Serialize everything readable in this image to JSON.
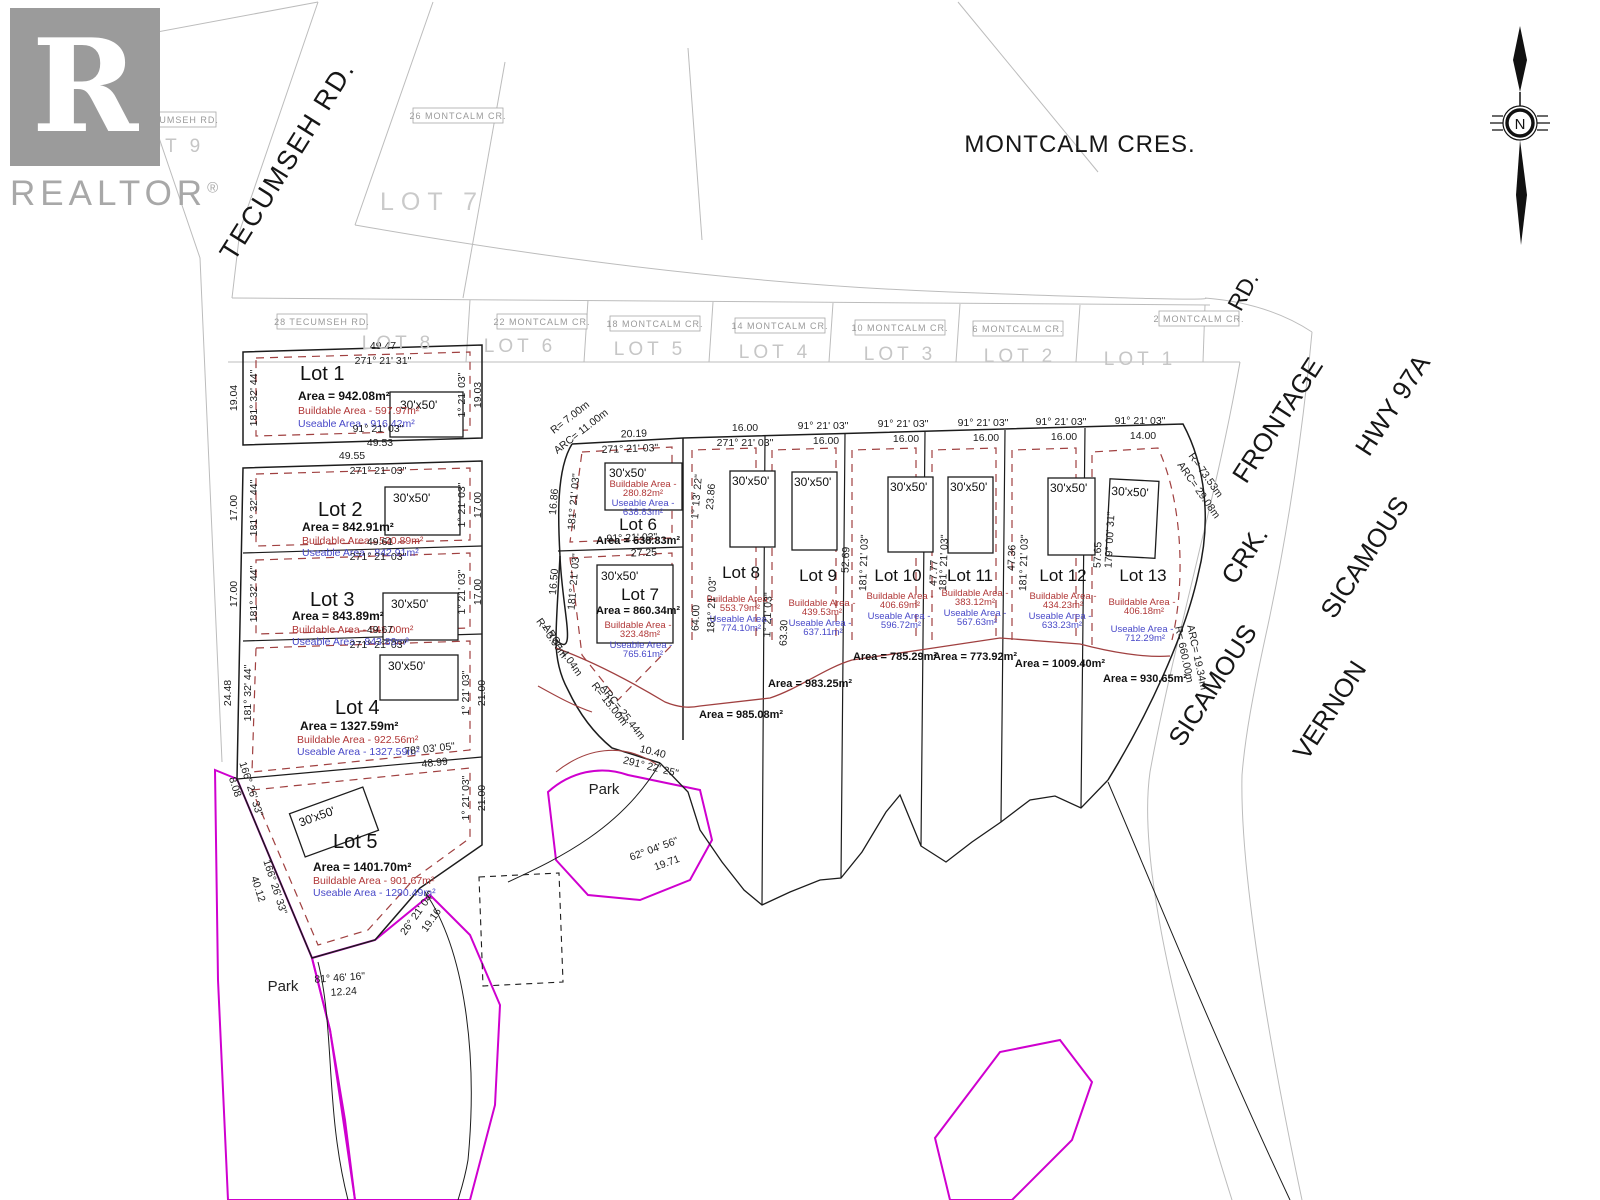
{
  "branding": {
    "logo_letter": "R",
    "logo_text": "REALTOR",
    "reg": "®"
  },
  "north": {
    "label": "N"
  },
  "streets": {
    "tecumseh": "TECUMSEH RD.",
    "montcalm": "MONTCALM CRES.",
    "rd": "RD.",
    "frontage_sicamous": "SICAMOUS",
    "frontage_crk": "CRK.",
    "frontage_frontage": "FRONTAGE",
    "vernon": "VERNON",
    "sicamous": "SICAMOUS",
    "hwy": "HWY 97A"
  },
  "park": {
    "label": "Park"
  },
  "common": {
    "building": "30'x50'",
    "area_label": "Area = ",
    "buildable_label": "Buildable Area - ",
    "useable_label": "Useable Area - "
  },
  "existing_lots": [
    {
      "address": "34 TECUMSEH RD.",
      "lot": "LOT 9"
    },
    {
      "address": "28 TECUMSEH RD.",
      "lot": "LOT 8"
    },
    {
      "address": "26 MONTCALM CR.",
      "lot": "LOT 7"
    },
    {
      "address": "22 MONTCALM CR.",
      "lot": "LOT 6"
    },
    {
      "address": "18 MONTCALM CR.",
      "lot": "LOT 5"
    },
    {
      "address": "14 MONTCALM CR.",
      "lot": "LOT 4"
    },
    {
      "address": "10 MONTCALM CR.",
      "lot": "LOT 3"
    },
    {
      "address": "6 MONTCALM CR.",
      "lot": "LOT 2"
    },
    {
      "address": "2 MONTCALM CR.",
      "lot": "LOT 1"
    }
  ],
  "lots": [
    {
      "name": "Lot 1",
      "area": "942.08m²",
      "buildable": "597.97m²",
      "useable": "916.42m²"
    },
    {
      "name": "Lot 2",
      "area": "842.91m²",
      "buildable": "520.89m²",
      "useable": "842.91m²"
    },
    {
      "name": "Lot 3",
      "area": "843.89m²",
      "buildable": "541.00m²",
      "useable": "843.89m²"
    },
    {
      "name": "Lot 4",
      "area": "1327.59m²",
      "buildable": "922.56m²",
      "useable": "1327.59m²"
    },
    {
      "name": "Lot 5",
      "area": "1401.70m²",
      "buildable": "901.67m²",
      "useable": "1290.49m²"
    },
    {
      "name": "Lot 6",
      "area": "638.83m²",
      "buildable": "280.82m²",
      "useable": "638.83m²"
    },
    {
      "name": "Lot 7",
      "area": "860.34m²",
      "buildable": "323.48m²",
      "useable": "765.61m²"
    },
    {
      "name": "Lot 8",
      "area": "985.08m²",
      "buildable": "553.79m²",
      "useable": "774.10m²"
    },
    {
      "name": "Lot 9",
      "area": "983.25m²",
      "buildable": "439.53m²",
      "useable": "637.11m²"
    },
    {
      "name": "Lot 10",
      "area": "785.29m²",
      "buildable": "406.69m²",
      "useable": "596.72m²"
    },
    {
      "name": "Lot 11",
      "area": "773.92m²",
      "buildable": "383.12m²",
      "useable": "567.63m²"
    },
    {
      "name": "Lot 12",
      "area": "1009.40m²",
      "buildable": "434.23m²",
      "useable": "633.23m²"
    },
    {
      "name": "Lot 13",
      "area": "930.65m²",
      "buildable": "406.18m²",
      "useable": "712.29m²"
    }
  ],
  "dims": [
    "49.47",
    "271° 21' 31\"",
    "19.04",
    "181° 32' 44\"",
    "1° 21' 03\"",
    "19.03",
    "91° 21' 03\"",
    "49.53",
    "49.55",
    "271° 21' 03\"",
    "17.00",
    "181° 32' 44\"",
    "1° 21' 03\"",
    "17.00",
    "49.61",
    "271° 21' 03\"",
    "17.00",
    "181° 32' 44\"",
    "1° 21' 03\"",
    "17.00",
    "49.67",
    "271° 21' 03\"",
    "24.48",
    "181° 32' 44\"",
    "1° 21' 03\"",
    "21.00",
    "78° 03' 05\"",
    "48.99",
    "166° 26' 33\"",
    "8.08",
    "166° 26' 33\"",
    "40.12",
    "81° 46' 16\"",
    "12.24",
    "26° 21' 04\"",
    "19.16",
    "62° 04' 56\"",
    "19.71",
    "1° 21' 03\"",
    "21.00",
    "R= 7.00m",
    "ARC= 11.00m",
    "20.19",
    "271° 21' 03\"",
    "16.86",
    "181° 21' 03\"",
    "1° 13' 22\"",
    "23.86",
    "91° 21' 03\"",
    "27.25",
    "16.50",
    "181° 21' 03\"",
    "R= 3.00m",
    "ARC= 4.04m",
    "R= 15.00m",
    "ARC= 25.44m",
    "10.40",
    "291° 22' 25\"",
    "16.00",
    "271° 21' 03\"",
    "64.00",
    "181° 21' 03\"",
    "1° 21' 03\"",
    "63.30",
    "91° 21' 03\"",
    "16.00",
    "52.69",
    "91° 21' 03\"",
    "16.00",
    "181° 21' 03\"",
    "47.77",
    "91° 21' 03\"",
    "16.00",
    "181° 21' 03\"",
    "47.36",
    "91° 21' 03\"",
    "16.00",
    "181° 21' 03\"",
    "57.65",
    "91° 21' 03\"",
    "14.00",
    "179° 00' 31\"",
    "R= 73.53m",
    "ARC= 29.08m",
    "R= 660.00m",
    "ARC= 19.34m"
  ],
  "colors": {
    "buildable": "#b03636",
    "useable": "#4848c8",
    "park": "#cf00cf",
    "line": "#1c1c1c",
    "gray": "#bcbcbc"
  }
}
